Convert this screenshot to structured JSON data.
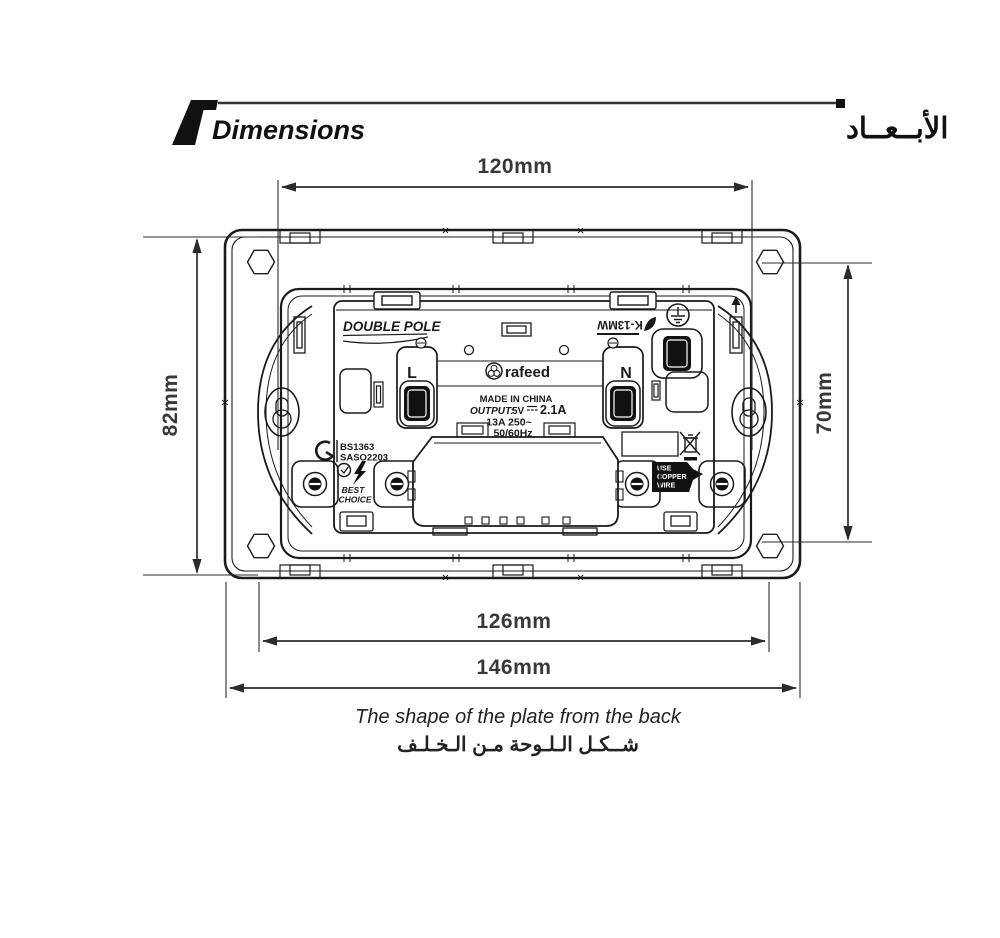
{
  "header": {
    "title_en": "Dimensions",
    "title_ar": "الأبــعــاد"
  },
  "dimensions": {
    "top_width": "120mm",
    "plate_height": "82mm",
    "screw_height": "70mm",
    "mechanism_width": "126mm",
    "plate_width": "146mm"
  },
  "caption": {
    "en": "The shape of the plate from the back",
    "ar": "شــكـل الـلـوحة مـن الـخـلـف"
  },
  "plate": {
    "pole_label": "DOUBLE POLE",
    "model": "K-13MW",
    "brand": "rafeed",
    "made_in": "MADE IN CHINA",
    "output_label": "OUTPUT:",
    "output_volts": "5V",
    "output_amps": "2.1A",
    "rating": "13A 250~",
    "frequency": "50/60Hz",
    "live_label": "L",
    "neutral_label": "N",
    "standard_1": "BS1363",
    "standard_2": "SASO2203",
    "badge_line_1": "BEST",
    "badge_line_2": "CHOICE",
    "wire_note_1": "USE",
    "wire_note_2": "COPPER",
    "wire_note_3": "WIRE"
  },
  "colors": {
    "line": "#1a1a1a",
    "dim": "#383838",
    "background": "#ffffff"
  }
}
